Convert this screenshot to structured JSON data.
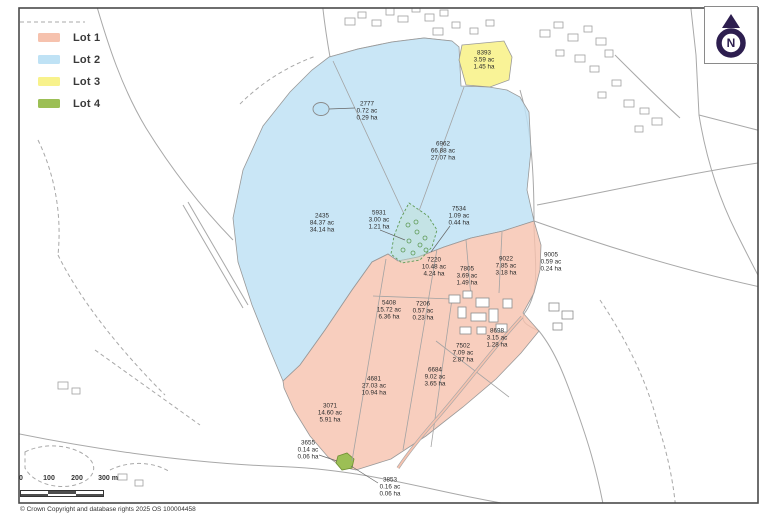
{
  "map": {
    "type": "land-plan",
    "copyright": "© Crown Copyright and database rights 2025 OS 100004458"
  },
  "legend": {
    "items": [
      {
        "label": "Lot 1",
        "color": "#f6c2ae"
      },
      {
        "label": "Lot 2",
        "color": "#bfe2f5"
      },
      {
        "label": "Lot 3",
        "color": "#f8f28c"
      },
      {
        "label": "Lot 4",
        "color": "#9cbf55"
      }
    ]
  },
  "north_indicator": {
    "label": "N",
    "color": "#2d1e4f"
  },
  "scale_bar": {
    "tick_labels": [
      "0",
      "100",
      "200",
      "300 m"
    ]
  },
  "parcels": [
    {
      "id": "8393",
      "acres": "3.59 ac",
      "hectares": "1.45 ha",
      "x": 484,
      "y": 60
    },
    {
      "id": "2777",
      "acres": "0.72 ac",
      "hectares": "0.29 ha",
      "x": 367,
      "y": 111
    },
    {
      "id": "6962",
      "acres": "66.88 ac",
      "hectares": "27.07 ha",
      "x": 443,
      "y": 151
    },
    {
      "id": "2435",
      "acres": "84.37 ac",
      "hectares": "34.14 ha",
      "x": 322,
      "y": 223
    },
    {
      "id": "5931",
      "acres": "3.00 ac",
      "hectares": "1.21 ha",
      "x": 379,
      "y": 220
    },
    {
      "id": "7534",
      "acres": "1.09 ac",
      "hectares": "0.44 ha",
      "x": 459,
      "y": 216
    },
    {
      "id": "7220",
      "acres": "10.48 ac",
      "hectares": "4.24 ha",
      "x": 434,
      "y": 267
    },
    {
      "id": "7805",
      "acres": "3.69 ac",
      "hectares": "1.49 ha",
      "x": 467,
      "y": 276
    },
    {
      "id": "9022",
      "acres": "7.85 ac",
      "hectares": "3.18 ha",
      "x": 506,
      "y": 266
    },
    {
      "id": "9005",
      "acres": "0.59 ac",
      "hectares": "0.24 ha",
      "x": 551,
      "y": 262
    },
    {
      "id": "5408",
      "acres": "15.72 ac",
      "hectares": "6.36 ha",
      "x": 389,
      "y": 310
    },
    {
      "id": "7206",
      "acres": "0.57 ac",
      "hectares": "0.23 ha",
      "x": 423,
      "y": 311
    },
    {
      "id": "8698",
      "acres": "3.15 ac",
      "hectares": "1.28 ha",
      "x": 497,
      "y": 338
    },
    {
      "id": "7502",
      "acres": "7.09 ac",
      "hectares": "2.87 ha",
      "x": 463,
      "y": 353
    },
    {
      "id": "6684",
      "acres": "9.02 ac",
      "hectares": "3.65 ha",
      "x": 435,
      "y": 377
    },
    {
      "id": "4681",
      "acres": "27.03 ac",
      "hectares": "10.94 ha",
      "x": 374,
      "y": 386
    },
    {
      "id": "3071",
      "acres": "14.60 ac",
      "hectares": "5.91 ha",
      "x": 330,
      "y": 413
    },
    {
      "id": "3655",
      "acres": "0.14 ac",
      "hectares": "0.06 ha",
      "x": 308,
      "y": 450
    },
    {
      "id": "3853",
      "acres": "0.16 ac",
      "hectares": "0.06 ha",
      "x": 390,
      "y": 487
    }
  ]
}
